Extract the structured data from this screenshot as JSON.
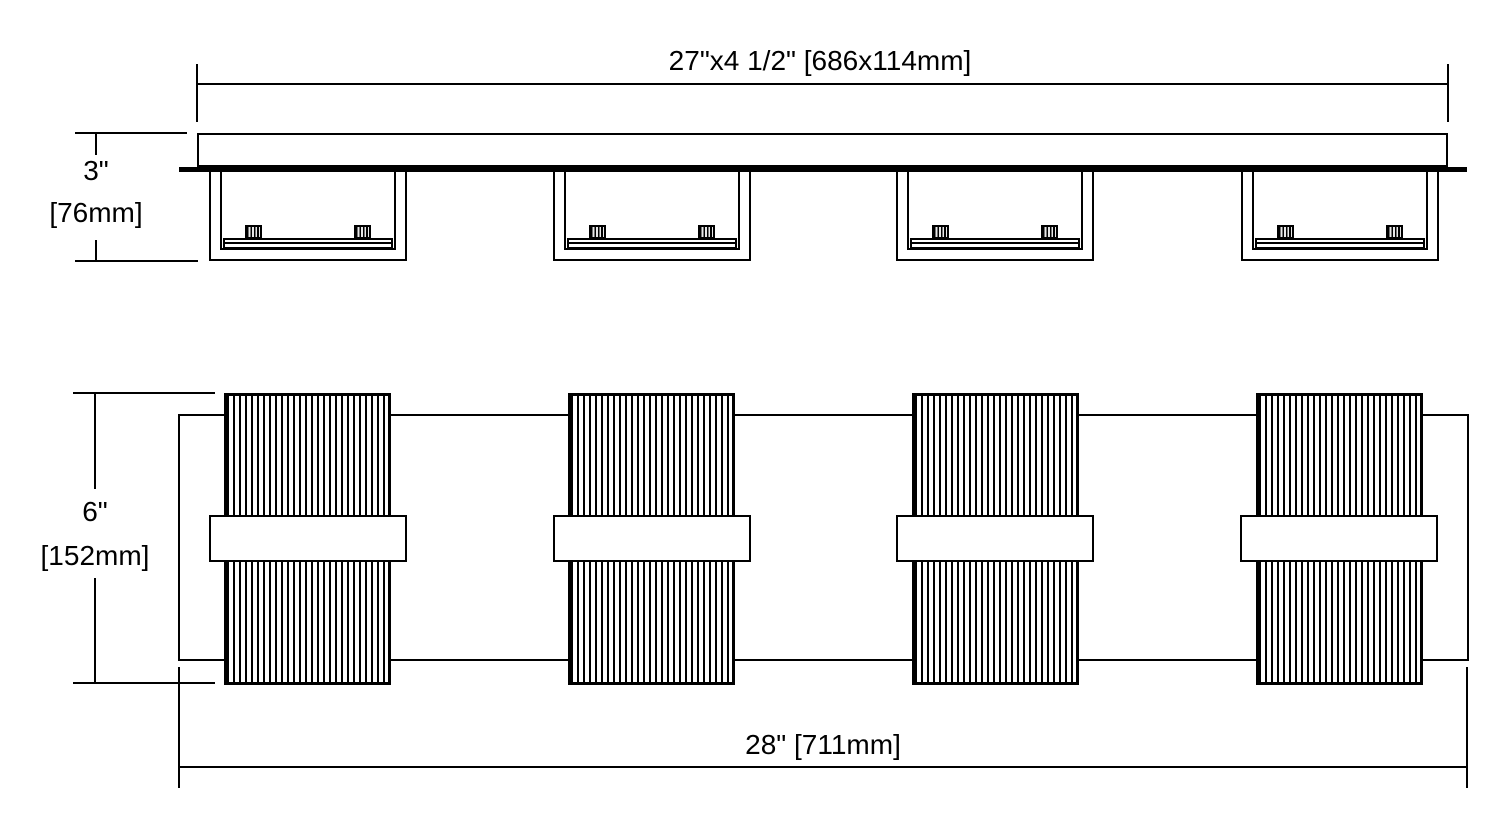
{
  "drawing": {
    "line_color": "#000000",
    "background_color": "#ffffff",
    "light_count": 4,
    "top_view": {
      "width_dimension_label": "27\"x4 1/2\" [686x114mm]",
      "depth_dimension_inches": "3\"",
      "depth_dimension_mm": "[76mm]"
    },
    "front_view": {
      "height_dimension_inches": "6\"",
      "height_dimension_mm": "[152mm]",
      "width_dimension_label": "28\" [711mm]"
    }
  }
}
